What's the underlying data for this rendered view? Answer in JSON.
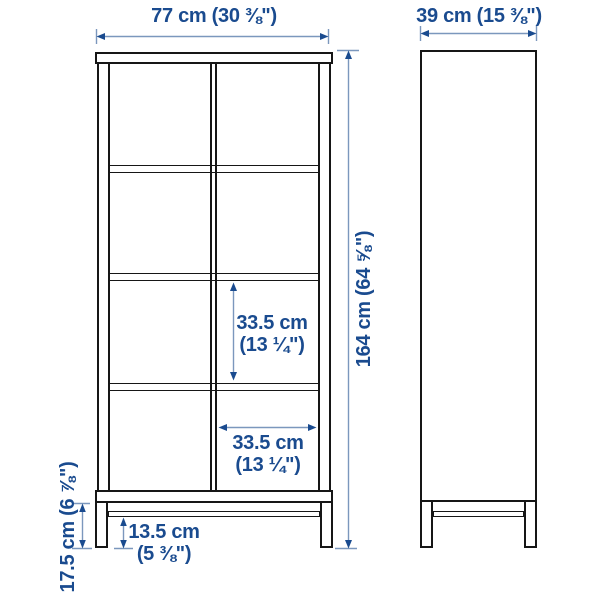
{
  "diagram": {
    "kind": "furniture dimension drawing",
    "views": {
      "front": "front elevation",
      "side": "side elevation"
    },
    "dimensions": {
      "width": "77 cm (30 ⅜\")",
      "depth": "39 cm (15 ⅜\")",
      "height": "164 cm (64 ⅝\")",
      "compartment_height": {
        "metric": "33.5 cm",
        "imperial": "(13 ¼\")"
      },
      "compartment_width": {
        "metric": "33.5 cm",
        "imperial": "(13 ¼\")"
      },
      "leg_height": "17.5 cm (6 ⅞\")",
      "floor_clearance": {
        "metric": "13.5 cm",
        "imperial": "(5 ⅜\")"
      }
    },
    "colors": {
      "dimension_text": "#1a4b8f",
      "dimension_line": "#7b97bd",
      "outline": "#161616",
      "background": "#ffffff"
    }
  }
}
